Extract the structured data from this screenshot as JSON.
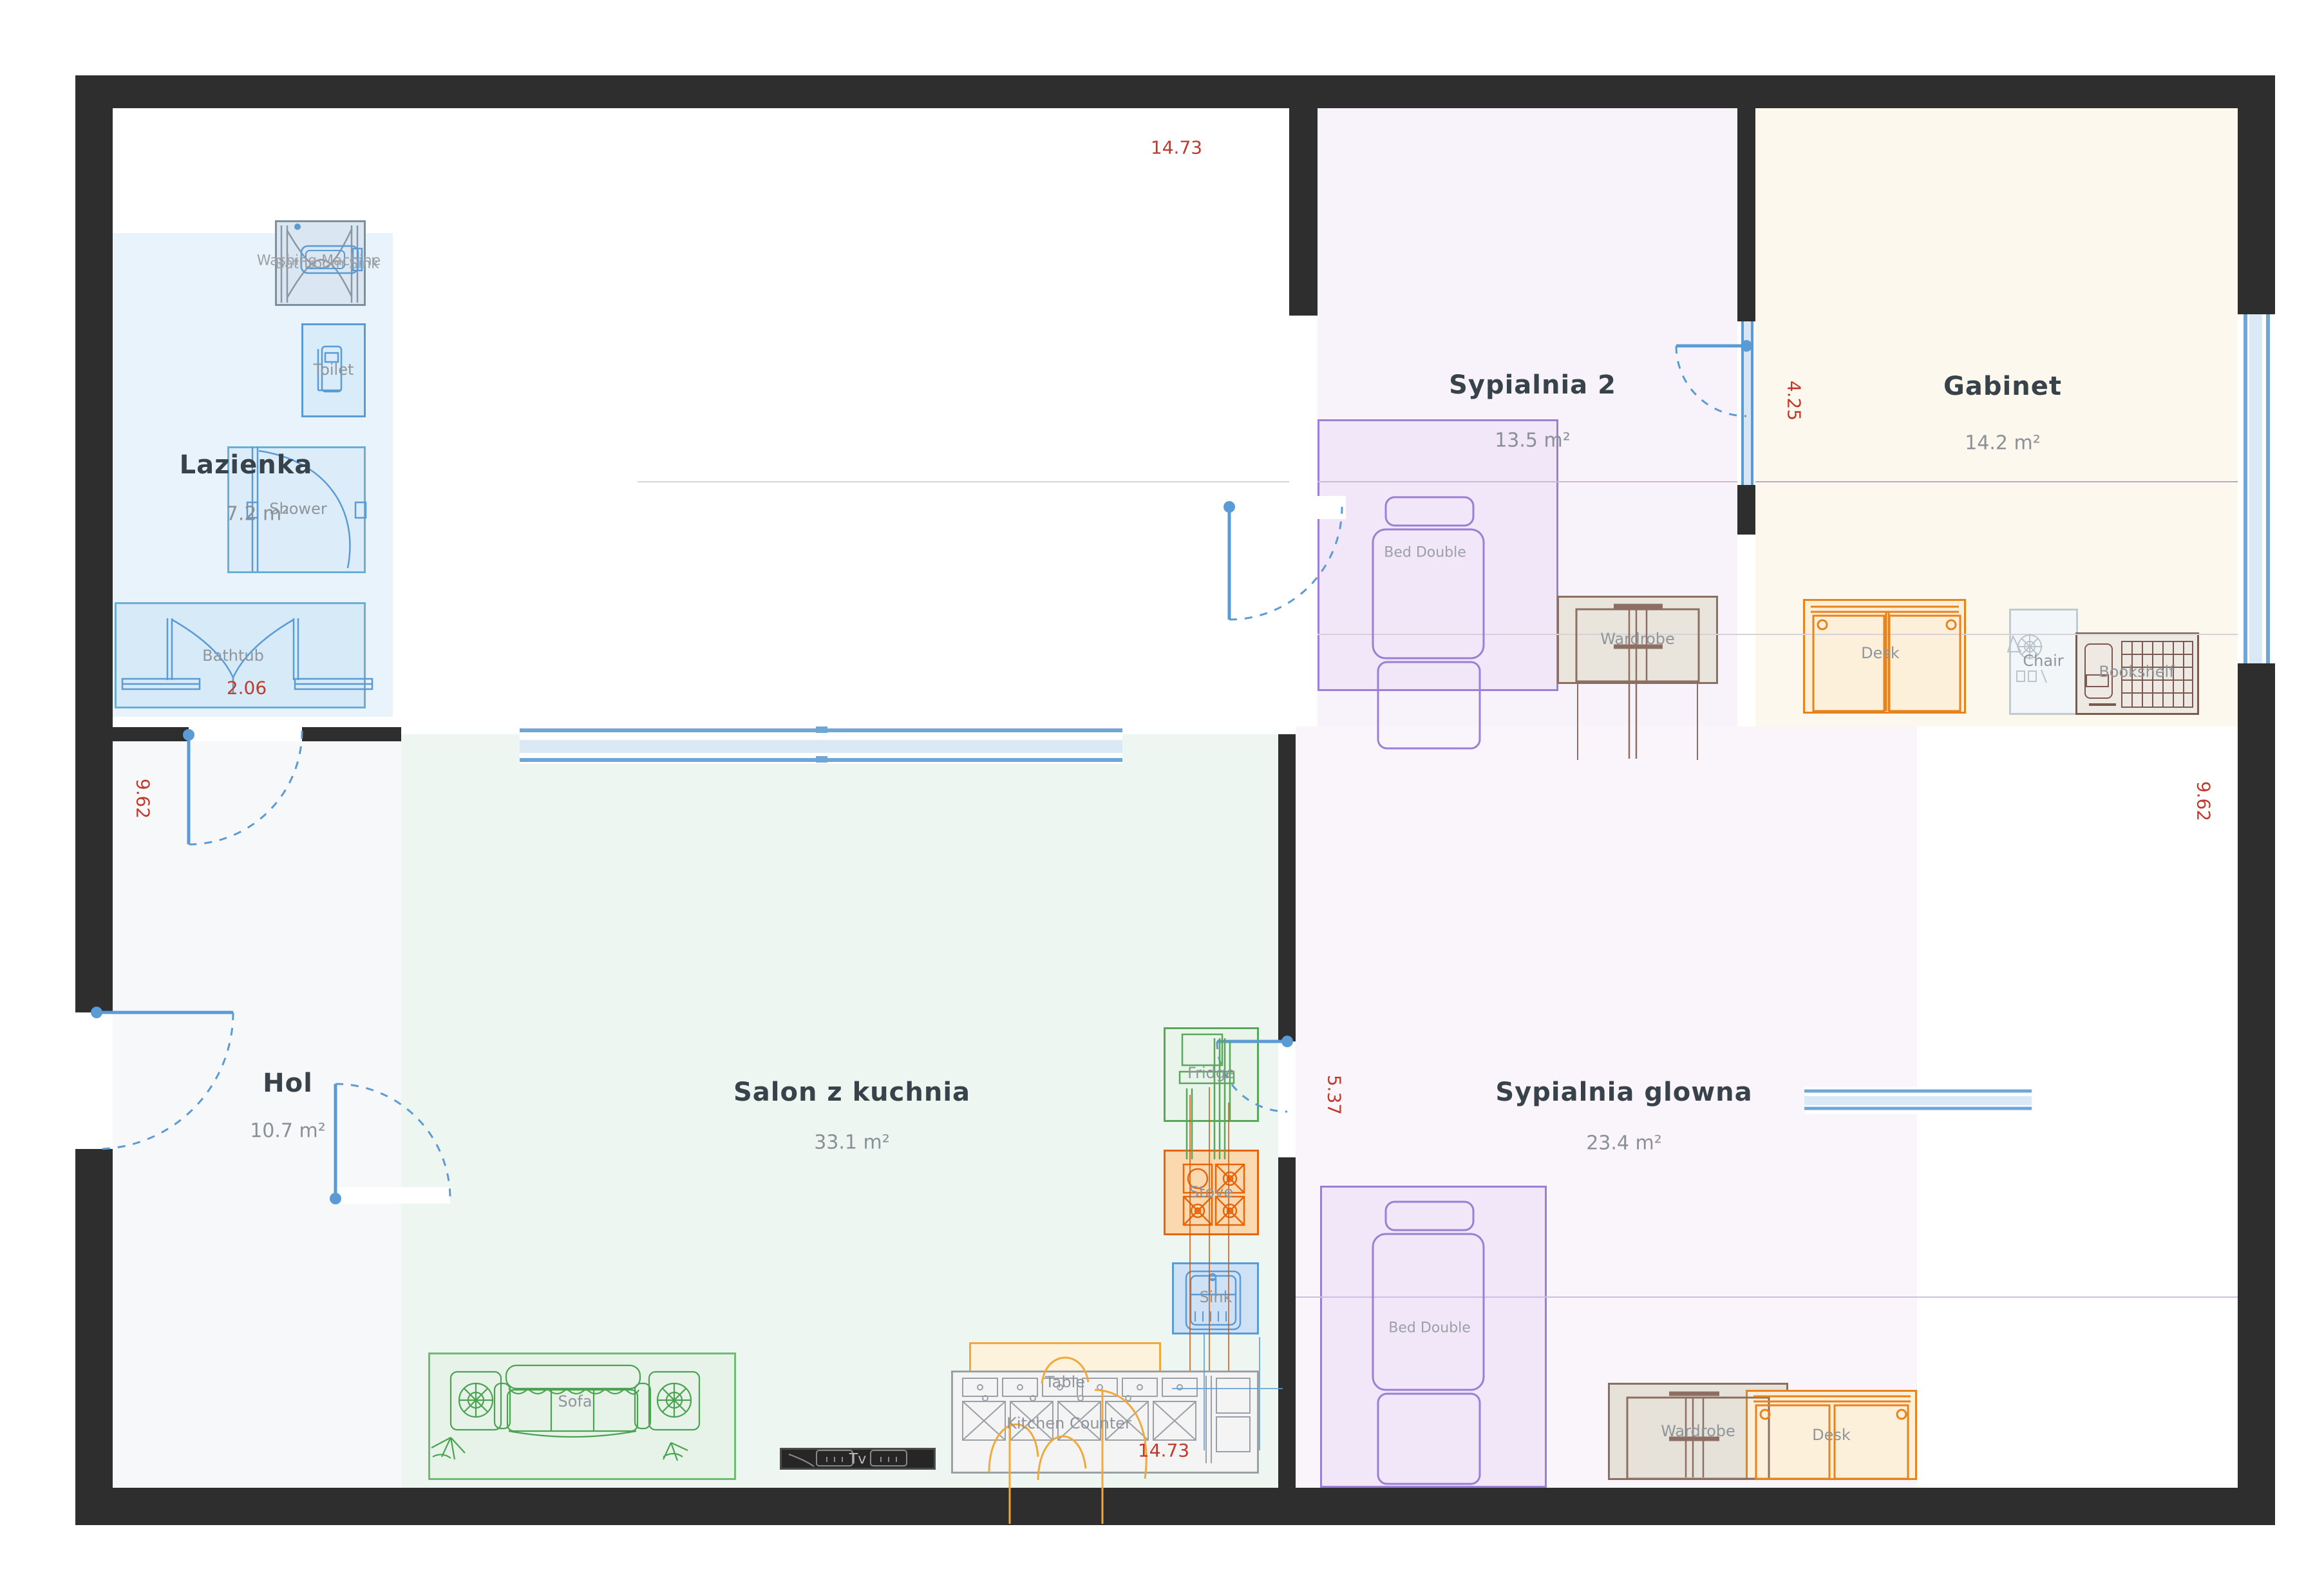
{
  "rooms": {
    "lazienka": {
      "name": "Lazienka",
      "area": "7.2 m²"
    },
    "hol": {
      "name": "Hol",
      "area": "10.7 m²"
    },
    "salon": {
      "name": "Salon z kuchnia",
      "area": "33.1 m²"
    },
    "sypialnia2": {
      "name": "Sypialnia 2",
      "area": "13.5 m²"
    },
    "gabinet": {
      "name": "Gabinet",
      "area": "14.2 m²"
    },
    "sypialnia_glowna": {
      "name": "Sypialnia glowna",
      "area": "23.4 m²"
    }
  },
  "furniture": {
    "washing_machine": "Washing Machine",
    "bathroom_sink": "Bathroom Sink",
    "toilet": "Toilet",
    "shower": "Shower",
    "bathtub": "Bathtub",
    "bed_double": "Bed Double",
    "wardrobe": "Wardrobe",
    "desk": "Desk",
    "chair": "Chair",
    "bookshelf": "Bookshelf",
    "sofa": "Sofa",
    "tv": "Tv",
    "table": "Table",
    "kitchen_counter": "Kitchen Counter",
    "fridge": "Fridge",
    "stove": "Stove",
    "sink": "Sink"
  },
  "dimensions": {
    "top_width": "14.73",
    "bottom_width": "14.73",
    "left_height": "9.62",
    "right_height": "9.62",
    "bathtub": "2.06",
    "gabinet_wall": "4.25",
    "salon_bedroom_wall": "5.37"
  },
  "colors": {
    "wall": "#2e2e2e",
    "door_window_blue": "#5b9bd5",
    "dimension_red": "#c0392b",
    "lazienka_fill": "#e9f3fb",
    "hol_fill": "#f7f8f9",
    "salon_fill": "#edf6f0",
    "sypialnia_fill": "#f2e7f8",
    "gabinet_fill": "#fdf8ee",
    "desk_accent": "#e8821a",
    "stove_accent": "#e8650a",
    "sofa_accent": "#4aa351",
    "wardrobe_accent": "#8d6e63"
  }
}
